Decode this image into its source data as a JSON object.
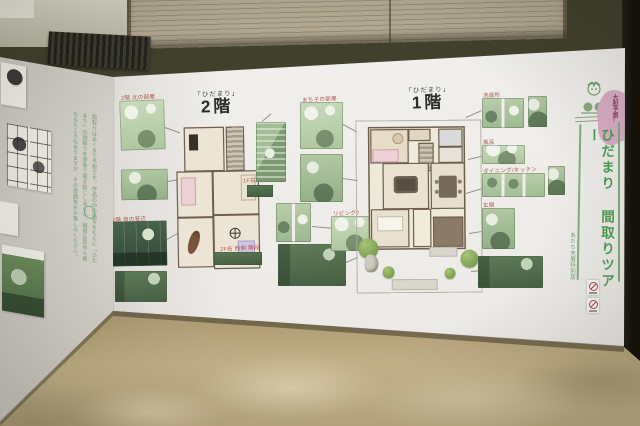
{
  "colors": {
    "title_green": "#4f9d58",
    "caption_red": "#b0544a",
    "bubble_pink": "#d9aec6",
    "panel_green": "#b7cdaa",
    "wall_white": "#efeeea",
    "floor_tan": "#c0af86"
  },
  "icons": {
    "no_photography": "no-photography-badge",
    "no_flash": "no-flash-badge"
  },
  "title": {
    "bubble": "大胆予想!",
    "main": "ひだまり 間取りツアー",
    "subtitle": "あだち充展特別版"
  },
  "plans": {
    "floor2": {
      "tag": "「ひだまり」",
      "label": "2階"
    },
    "floor1": {
      "tag": "「ひだまり」",
      "label": "1階"
    }
  },
  "captions": {
    "c_left_top": "2階 北の部屋",
    "c_left_night": "2階 夜の窓辺",
    "c_mid_top": "まち子の部屋",
    "c_living": "リビング?",
    "c_washroom": "洗面所",
    "c_bath": "風呂",
    "c_dining": "ダイニング/キッチン",
    "c_entrance": "玄関",
    "c_note_right": "1F右 廊下",
    "c_note_bottom": "2F右 西側 階段"
  },
  "left_wall": {
    "body": "間取りはあくまで予想です。作品の中の描写をもとに「ひだまり」の間取りを想像で描き起こしました。細部は原作と異なるところもありますが、その雰囲気をお楽しみください。"
  }
}
